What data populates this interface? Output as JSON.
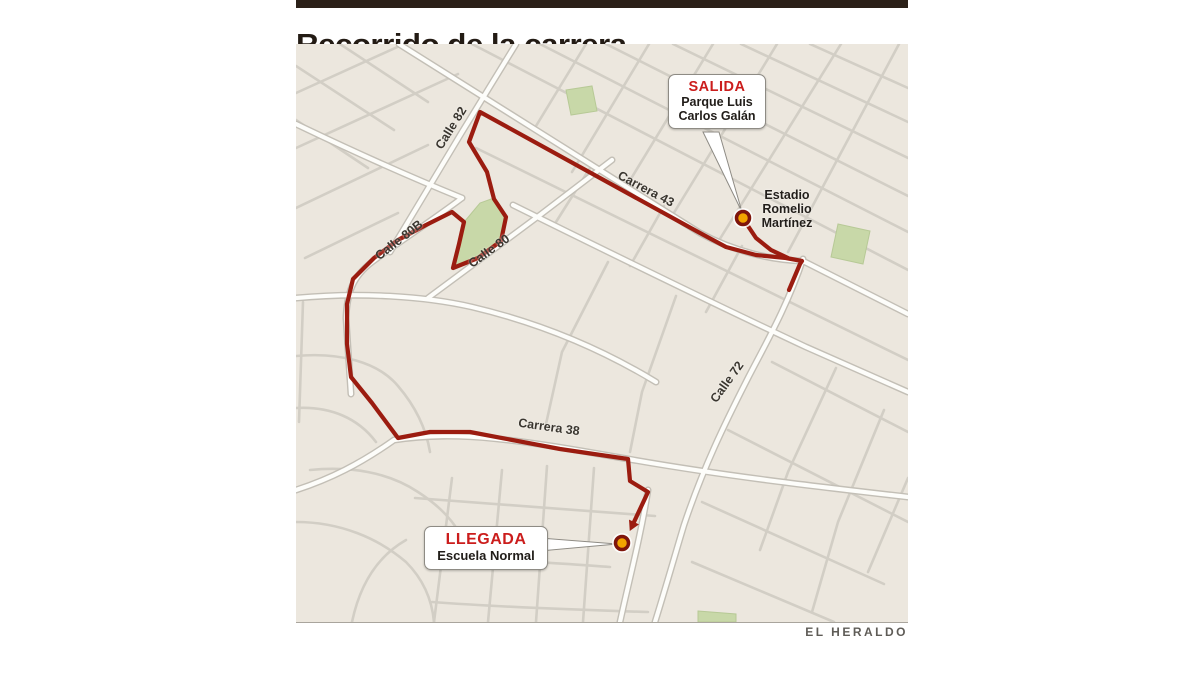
{
  "header": {
    "title": "Recorrido de la carrera"
  },
  "credit": "EL HERALDO",
  "colors": {
    "top_bar": "#2b2018",
    "map_background": "#ece7de",
    "route": "#9b1c10",
    "marker_fill": "#f2a400",
    "marker_ring": "#7e150b",
    "park": "#c8d8a8",
    "callout_red": "#cb1d1c",
    "street_minor": "#d2cec5",
    "street_major": "#fdfdfa"
  },
  "map": {
    "callouts": [
      {
        "id": "salida",
        "title": "SALIDA",
        "lines": [
          "Parque Luis",
          "Carlos Galán"
        ]
      },
      {
        "id": "llegada",
        "title": "LLEGADA",
        "lines": [
          "Escuela Normal"
        ]
      }
    ],
    "place_labels": [
      {
        "id": "estadio",
        "text": [
          "Estadio",
          "Romelio",
          "Martínez"
        ],
        "x": 787,
        "y": 188
      }
    ],
    "street_labels": [
      {
        "text": "Calle 82",
        "x": 451,
        "y": 128,
        "angle": -58
      },
      {
        "text": "Carrera 43",
        "x": 646,
        "y": 189,
        "angle": 28
      },
      {
        "text": "Calle 80B",
        "x": 399,
        "y": 240,
        "angle": -38
      },
      {
        "text": "Calle 80",
        "x": 489,
        "y": 251,
        "angle": -36
      },
      {
        "text": "Calle 72",
        "x": 727,
        "y": 382,
        "angle": -54
      },
      {
        "text": "Carrera 38",
        "x": 549,
        "y": 427,
        "angle": 8
      }
    ],
    "route_points": [
      [
        789,
        290
      ],
      [
        800,
        264
      ],
      [
        802,
        261
      ],
      [
        786,
        258
      ],
      [
        756,
        255
      ],
      [
        726,
        247
      ],
      [
        700,
        233
      ],
      [
        480,
        112
      ],
      [
        469,
        142
      ],
      [
        487,
        172
      ],
      [
        494,
        199
      ],
      [
        506,
        217
      ],
      [
        501,
        241
      ],
      [
        478,
        258
      ],
      [
        453,
        268
      ],
      [
        459,
        244
      ],
      [
        464,
        222
      ],
      [
        452,
        212
      ],
      [
        426,
        225
      ],
      [
        398,
        240
      ],
      [
        374,
        258
      ],
      [
        353,
        279
      ],
      [
        347,
        304
      ],
      [
        347,
        344
      ],
      [
        351,
        377
      ],
      [
        372,
        403
      ],
      [
        398,
        438
      ],
      [
        430,
        432
      ],
      [
        470,
        432
      ],
      [
        560,
        449
      ],
      [
        628,
        459
      ],
      [
        630,
        481
      ],
      [
        648,
        492
      ],
      [
        634,
        522
      ]
    ],
    "salida_spur": [
      [
        744,
        220
      ],
      [
        756,
        238
      ],
      [
        771,
        250
      ],
      [
        788,
        258
      ]
    ],
    "markers": [
      {
        "id": "salida-dot",
        "x": 743,
        "y": 218
      },
      {
        "id": "llegada-dot",
        "x": 622,
        "y": 543
      }
    ]
  }
}
